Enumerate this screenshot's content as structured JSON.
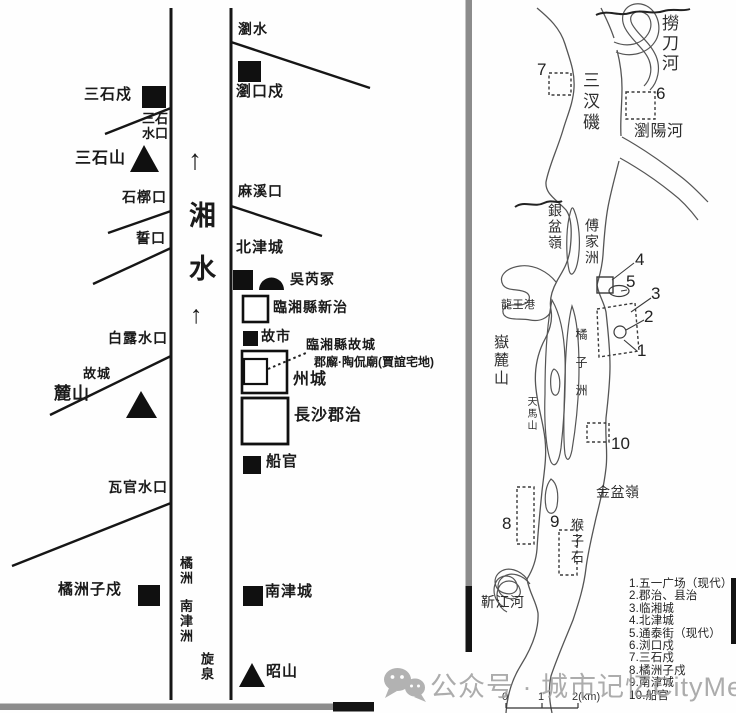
{
  "left_map": {
    "labels": {
      "river_arrow": "↑",
      "river_xiang": "湘",
      "river_shui": "水",
      "sanshi_fort": "三石戍",
      "sanshi_watermouth": "三石\n水口",
      "sanshi_mountain": "三石山",
      "shiguo_mouth": "石槨口",
      "shi_mouth": "誓口",
      "bailu_watermouth": "白露水口",
      "old_city": "故城",
      "lu_mountain": "麓山",
      "waguan_watermouth": "瓦官水口",
      "juzhouzi_fort": "橘洲子戍",
      "liu_river": "瀏水",
      "liukou_fort": "瀏口戍",
      "maxi_mouth": "麻溪口",
      "beijin_city": "北津城",
      "wurui_tomb": "吳芮冢",
      "linxiang_new_seat": "臨湘縣新治",
      "old_market": "故市",
      "linxiang_old_city": "臨湘縣故城",
      "office_temple": "郡廨·陶侃廟(賈誼宅地)",
      "zhou_city": "州城",
      "changsha_seat": "長沙郡治",
      "chuan_guan": "船官",
      "nanjin_city": "南津城",
      "zhao_mountain": "昭山",
      "ju_isle": "橘洲",
      "nanjin_isle": "南津洲",
      "xuan_spring": "旋泉"
    }
  },
  "right_map": {
    "labels": {
      "laodao_river": "撈刀河",
      "sancha_ji": "三汊磯",
      "liuyang_river": "瀏陽河",
      "yinpen_ridge": "銀盆嶺",
      "fujia_isle": "傅家洲",
      "longwang_port": "龍王港",
      "yuelu_mountain": "嶽麓山",
      "tianma_mountain": "天馬山",
      "juzi_isle": "橘子洲",
      "jinpen_ridge": "金盆嶺",
      "houzi_rock": "猴子石",
      "jinjiang_river": "靳江河"
    },
    "numbers": {
      "n1": "1",
      "n2": "2",
      "n3": "3",
      "n4": "4",
      "n5": "5",
      "n6": "6",
      "n7": "7",
      "n8": "8",
      "n9": "9",
      "n10": "10"
    },
    "legend_items": [
      "1.五一广场（现代）",
      "2.郡治、县治",
      "3.临湘城",
      "4.北津城",
      "5.通泰街（现代）",
      "6.浏口戍",
      "7.三石戍",
      "8.橘洲子戍",
      "9.南津城",
      "10.船官"
    ],
    "scale": {
      "t0": "0",
      "t1": "1",
      "t2": "2(km)"
    }
  },
  "watermark": {
    "text": "公众号 · 城市记忆CityMemory"
  }
}
